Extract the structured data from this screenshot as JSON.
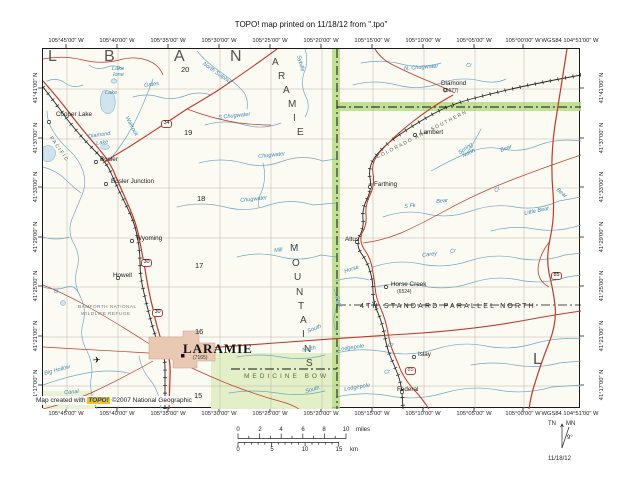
{
  "header": {
    "title": "TOPO! map printed on 11/18/12 from \".tpo\""
  },
  "coords": {
    "longitudes": [
      {
        "text": "105°45'00\" W",
        "x": 66
      },
      {
        "text": "105°40'00\" W",
        "x": 117
      },
      {
        "text": "105°35'00\" W",
        "x": 168
      },
      {
        "text": "105°30'00\" W",
        "x": 219
      },
      {
        "text": "105°25'00\" W",
        "x": 270
      },
      {
        "text": "105°20'00\" W",
        "x": 321
      },
      {
        "text": "105°15'00\" W",
        "x": 372
      },
      {
        "text": "105°10'00\" W",
        "x": 423
      },
      {
        "text": "105°05'00\" W",
        "x": 474
      },
      {
        "text": "105°00'00\" W",
        "x": 523
      },
      {
        "text": "WGS84 104°51'00\" W",
        "x": 570
      }
    ],
    "latitudes": [
      {
        "text": "41°41'00\" N",
        "y": 88
      },
      {
        "text": "41°37'00\" N",
        "y": 138
      },
      {
        "text": "41°33'00\" N",
        "y": 187
      },
      {
        "text": "41°29'00\" N",
        "y": 237
      },
      {
        "text": "41°25'00\" N",
        "y": 286
      },
      {
        "text": "41°21'00\" N",
        "y": 336
      },
      {
        "text": "41°17'00\" N",
        "y": 385
      }
    ]
  },
  "map": {
    "credit": {
      "prefix": "Map created with ",
      "brand": "TOPO!",
      "suffix": " ©2007 National Geographic"
    },
    "labels": [
      {
        "text": "Cooper Lake",
        "x": 14,
        "y": 64,
        "cls": "town"
      },
      {
        "text": "Bosler",
        "x": 58,
        "y": 109,
        "cls": "town"
      },
      {
        "text": "Bosler Junction",
        "x": 69,
        "y": 131,
        "cls": "town"
      },
      {
        "text": "Wyoming",
        "x": 94,
        "y": 188,
        "cls": "town"
      },
      {
        "text": "Howell",
        "x": 71,
        "y": 225,
        "cls": "town"
      },
      {
        "text": "Diamond",
        "x": 399,
        "y": 33,
        "cls": "town"
      },
      {
        "text": "Lambert",
        "x": 378,
        "y": 82,
        "cls": "town"
      },
      {
        "text": "Farthing",
        "x": 332,
        "y": 134,
        "cls": "town"
      },
      {
        "text": "Altus",
        "x": 303,
        "y": 189,
        "cls": "town"
      },
      {
        "text": "Horse Creek",
        "x": 349,
        "y": 234,
        "cls": "town"
      },
      {
        "text": "Islay",
        "x": 376,
        "y": 304,
        "cls": "town"
      },
      {
        "text": "Federal",
        "x": 355,
        "y": 339,
        "cls": "town"
      },
      {
        "text": "LARAMIE",
        "x": 141,
        "y": 294,
        "cls": "city"
      },
      {
        "text": "(7165)",
        "x": 151,
        "y": 308,
        "cls": "elev"
      },
      {
        "text": "(5677)",
        "x": 402,
        "y": 41,
        "cls": "elev"
      },
      {
        "text": "(6524)",
        "x": 355,
        "y": 242,
        "cls": "elev"
      },
      {
        "text": "20",
        "x": 139,
        "y": 18,
        "cls": "secnum"
      },
      {
        "text": "19",
        "x": 142,
        "y": 81,
        "cls": "secnum"
      },
      {
        "text": "18",
        "x": 155,
        "y": 147,
        "cls": "secnum"
      },
      {
        "text": "17",
        "x": 153,
        "y": 214,
        "cls": "secnum"
      },
      {
        "text": "16",
        "x": 153,
        "y": 280,
        "cls": "secnum"
      },
      {
        "text": "15",
        "x": 152,
        "y": 344,
        "cls": "secnum"
      },
      {
        "text": "L",
        "x": 6,
        "y": 1,
        "cls": "county"
      },
      {
        "text": "B",
        "x": 62,
        "y": 1,
        "cls": "county"
      },
      {
        "text": "A",
        "x": 132,
        "y": 1,
        "cls": "county"
      },
      {
        "text": "N",
        "x": 188,
        "y": 1,
        "cls": "county"
      },
      {
        "text": "L",
        "x": 491,
        "y": 304,
        "cls": "county"
      },
      {
        "text": "A",
        "x": 230,
        "y": 10,
        "cls": "range"
      },
      {
        "text": "R",
        "x": 236,
        "y": 24,
        "cls": "range"
      },
      {
        "text": "A",
        "x": 241,
        "y": 38,
        "cls": "range"
      },
      {
        "text": "M",
        "x": 246,
        "y": 52,
        "cls": "range"
      },
      {
        "text": "I",
        "x": 251,
        "y": 66,
        "cls": "range"
      },
      {
        "text": "E",
        "x": 255,
        "y": 80,
        "cls": "range"
      },
      {
        "text": "M",
        "x": 248,
        "y": 196,
        "cls": "range"
      },
      {
        "text": "O",
        "x": 250,
        "y": 211,
        "cls": "range"
      },
      {
        "text": "U",
        "x": 252,
        "y": 225,
        "cls": "range"
      },
      {
        "text": "N",
        "x": 254,
        "y": 240,
        "cls": "range"
      },
      {
        "text": "T",
        "x": 256,
        "y": 254,
        "cls": "range"
      },
      {
        "text": "A",
        "x": 258,
        "y": 268,
        "cls": "range"
      },
      {
        "text": "I",
        "x": 260,
        "y": 282,
        "cls": "range"
      },
      {
        "text": "N",
        "x": 262,
        "y": 297,
        "cls": "range"
      },
      {
        "text": "S",
        "x": 264,
        "y": 311,
        "cls": "range"
      },
      {
        "text": "Lake",
        "x": 70,
        "y": 19,
        "cls": "water"
      },
      {
        "text": "Ione",
        "x": 71,
        "y": 25,
        "cls": "water"
      },
      {
        "text": "Lake",
        "x": 63,
        "y": 43,
        "cls": "water"
      },
      {
        "text": "Diamond",
        "x": 46,
        "y": 87,
        "rot": -8,
        "cls": "water"
      },
      {
        "text": "Lake",
        "x": 54,
        "y": 94,
        "rot": -8,
        "cls": "water"
      },
      {
        "text": "Gates",
        "x": 102,
        "y": 36,
        "rot": -8,
        "cls": "water"
      },
      {
        "text": "Wallrock",
        "x": 86,
        "y": 68,
        "rot": 62,
        "cls": "water"
      },
      {
        "text": "Sybille",
        "x": 258,
        "y": 7,
        "rot": 75,
        "cls": "water"
      },
      {
        "text": "North Sulphur",
        "x": 162,
        "y": 14,
        "rot": 35,
        "cls": "water"
      },
      {
        "text": "Chugwater",
        "x": 216,
        "y": 107,
        "rot": -6,
        "cls": "water"
      },
      {
        "text": "Chugwater",
        "x": 198,
        "y": 151,
        "rot": -6,
        "cls": "water"
      },
      {
        "text": "S Chugwater",
        "x": 176,
        "y": 68,
        "rot": -6,
        "cls": "water"
      },
      {
        "text": "N. Chugwater",
        "x": 362,
        "y": 19,
        "rot": -4,
        "cls": "water"
      },
      {
        "text": "Cr",
        "x": 424,
        "y": 16,
        "rot": -4,
        "cls": "water"
      },
      {
        "text": "Spring",
        "x": 416,
        "y": 104,
        "rot": -35,
        "cls": "water"
      },
      {
        "text": "North",
        "x": 420,
        "y": 107,
        "rot": -28,
        "cls": "water"
      },
      {
        "text": "Bear",
        "x": 458,
        "y": 101,
        "rot": -20,
        "cls": "water"
      },
      {
        "text": "Bear",
        "x": 516,
        "y": 140,
        "rot": 40,
        "cls": "water"
      },
      {
        "text": "Little Bear",
        "x": 482,
        "y": 164,
        "rot": -12,
        "cls": "water"
      },
      {
        "text": "S Fk",
        "x": 362,
        "y": 157,
        "rot": -6,
        "cls": "water"
      },
      {
        "text": "Bear",
        "x": 394,
        "y": 152,
        "rot": -6,
        "cls": "water"
      },
      {
        "text": "Cr",
        "x": 452,
        "y": 142,
        "rot": -35,
        "cls": "water"
      },
      {
        "text": "Carey",
        "x": 380,
        "y": 206,
        "rot": -8,
        "cls": "water"
      },
      {
        "text": "Cr",
        "x": 408,
        "y": 202,
        "rot": -8,
        "cls": "water"
      },
      {
        "text": "Horse",
        "x": 302,
        "y": 222,
        "rot": -18,
        "cls": "water"
      },
      {
        "text": "Mill",
        "x": 232,
        "y": 201,
        "rot": -6,
        "cls": "water"
      },
      {
        "text": "Cr",
        "x": 250,
        "y": 198,
        "rot": -6,
        "cls": "water"
      },
      {
        "text": "Lodgepole",
        "x": 296,
        "y": 300,
        "rot": -8,
        "cls": "water"
      },
      {
        "text": "Cr",
        "x": 346,
        "y": 296,
        "rot": -8,
        "cls": "water"
      },
      {
        "text": "Lodgepole",
        "x": 302,
        "y": 340,
        "rot": -10,
        "cls": "water"
      },
      {
        "text": "Cr",
        "x": 342,
        "y": 323,
        "rot": -10,
        "cls": "water"
      },
      {
        "text": "South",
        "x": 265,
        "y": 282,
        "rot": -22,
        "cls": "water"
      },
      {
        "text": "North",
        "x": 260,
        "y": 301,
        "rot": -12,
        "cls": "water"
      },
      {
        "text": "South",
        "x": 263,
        "y": 342,
        "rot": -16,
        "cls": "water"
      },
      {
        "text": "Fork",
        "x": 296,
        "y": 248,
        "rot": 70,
        "cls": "water"
      },
      {
        "text": "Big Hollow",
        "x": 2,
        "y": 324,
        "rot": -15,
        "cls": "water"
      },
      {
        "text": "Canal",
        "x": 22,
        "y": 343,
        "rot": -4,
        "cls": "water"
      },
      {
        "text": "BAMFORTH NATIONAL",
        "x": 36,
        "y": 258,
        "cls": "refuge"
      },
      {
        "text": "WILDLIFE REFUGE",
        "x": 39,
        "y": 265,
        "cls": "refuge"
      },
      {
        "text": "MEDICINE BOW",
        "x": 202,
        "y": 326,
        "cls": "forest"
      },
      {
        "text": "4TH STANDARD PARALLEL NORTH",
        "x": 318,
        "y": 255,
        "cls": "parallel"
      },
      {
        "text": "PACIFIC",
        "x": 10,
        "y": 88,
        "rot": 55,
        "cls": "rrname"
      },
      {
        "text": "COLORADO AND SOUTHERN",
        "x": 334,
        "y": 108,
        "rot": -27,
        "cls": "rrname"
      },
      {
        "text": "✈",
        "x": 51,
        "y": 308,
        "cls": "poi"
      },
      {
        "text": "34",
        "x": 119,
        "y": 72,
        "cls": "shield"
      },
      {
        "text": "30",
        "x": 99,
        "y": 211,
        "cls": "shield"
      },
      {
        "text": "30",
        "x": 110,
        "y": 261,
        "cls": "shield"
      },
      {
        "text": "85",
        "x": 509,
        "y": 224,
        "cls": "shield"
      },
      {
        "text": "85",
        "x": 363,
        "y": 319,
        "cls": "shieldred"
      }
    ]
  },
  "scalebar": {
    "miles_ticks": [
      {
        "text": "0",
        "x": 10
      },
      {
        "text": "2",
        "x": 32
      },
      {
        "text": "4",
        "x": 53
      },
      {
        "text": "6",
        "x": 75
      },
      {
        "text": "8",
        "x": 96
      },
      {
        "text": "10",
        "x": 118
      }
    ],
    "miles_unit": "miles",
    "km_ticks": [
      {
        "text": "0",
        "x": 10
      },
      {
        "text": "5",
        "x": 44
      },
      {
        "text": "10",
        "x": 77
      },
      {
        "text": "15",
        "x": 111
      }
    ],
    "km_unit": "km"
  },
  "declination": {
    "tn": "TN",
    "mn": "MN",
    "angle": "9°",
    "date": "11/18/12"
  }
}
